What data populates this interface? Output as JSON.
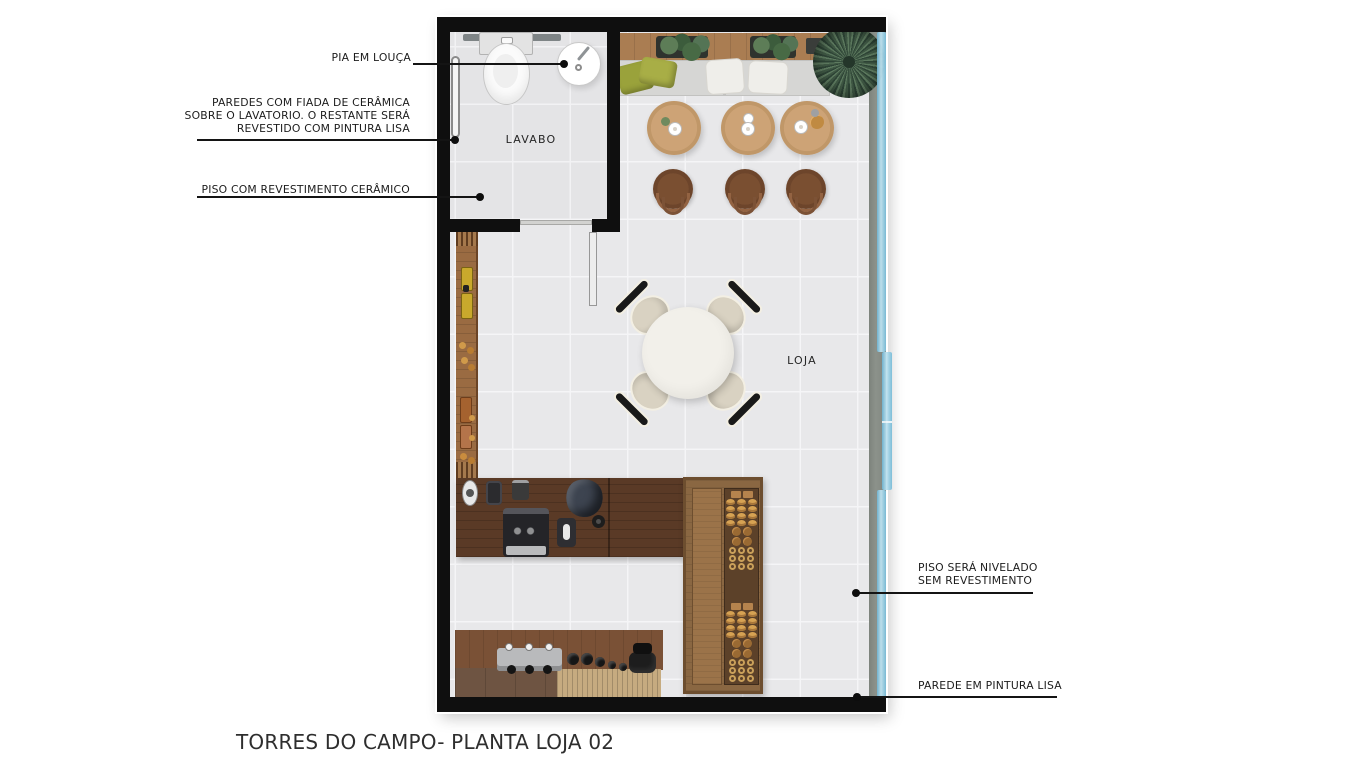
{
  "title": "TORRES DO CAMPO- PLANTA LOJA 02",
  "rooms": {
    "lavabo": "LAVABO",
    "loja": "LOJA"
  },
  "annotations": {
    "pia": "PIA EM LOUÇA",
    "paredes_l1": "PAREDES COM FIADA DE CERÂMICA",
    "paredes_l2": "SOBRE O LAVATORIO. O RESTANTE SERÁ",
    "paredes_l3": "REVESTIDO COM PINTURA LISA",
    "piso_ceramico": "PISO COM REVESTIMENTO CERÂMICO",
    "piso_nivelado_l1": "PISO SERÁ NIVELADO",
    "piso_nivelado_l2": "SEM REVESTIMENTO",
    "parede_lisa": "PAREDE EM PINTURA LISA"
  },
  "colors": {
    "wall": "#0f0f0f",
    "wallgray": "#868c85",
    "glass": "#7fc0dc",
    "glasslight": "#bfe2ef",
    "floor": "#e8e8ea",
    "floorline": "#f5f5f7",
    "lavfloor": "#e4e4e6",
    "woodbench": "#aa7d52",
    "woodtable": "#c09768",
    "woodstool": "#6d452b",
    "woodshelf": "#9a6b42",
    "woodcounter": "#5a3a26",
    "woodcabinet": "#8a6742",
    "cabinetdisplay": "#5c4129",
    "woodlight": "#c6ab80",
    "woodfrontdark": "#6e5442",
    "cushion": "#9aa23b",
    "plant": "#4c6b4a",
    "plantdark": "#33493a",
    "seat": "#d6d6d4",
    "pillow": "#efeeea",
    "chairseat": "#d9d2c2",
    "chairback": "#191919",
    "tabletop": "#f2f0ea",
    "steel": "#b9babc",
    "appliance": "#2b2b2e",
    "pastry": "#d6a253",
    "cookie": "#9a6a33",
    "ink": "#1c1c1c"
  }
}
